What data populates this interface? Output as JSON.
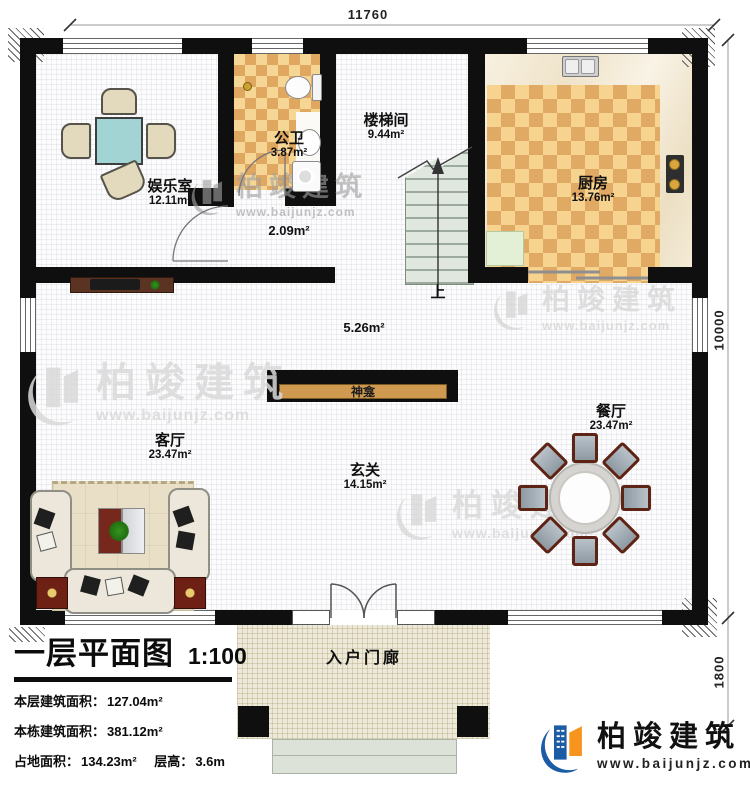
{
  "dimensions": {
    "top": "11760",
    "right_upper": "10000",
    "right_lower": "1800"
  },
  "rooms": {
    "entertainment": {
      "name": "娱乐室",
      "area": "12.11m²"
    },
    "bathroom": {
      "name": "公卫",
      "area": "3.87m²"
    },
    "corridor": {
      "area": "2.09m²"
    },
    "stairwell": {
      "name": "楼梯间",
      "area": "9.44m²"
    },
    "kitchen": {
      "name": "厨房",
      "area": "13.76m²"
    },
    "hall_mid": {
      "area": "5.26m²"
    },
    "shrine": {
      "name": "神龛"
    },
    "living": {
      "name": "客厅",
      "area": "23.47m²"
    },
    "foyer": {
      "name": "玄关",
      "area": "14.15m²"
    },
    "dining": {
      "name": "餐厅",
      "area": "23.47m²"
    },
    "porch": {
      "name": "入户门廊"
    }
  },
  "stairs": {
    "up_label": "上"
  },
  "title_block": {
    "title": "一层平面图",
    "scale": "1:100",
    "rows": [
      {
        "label": "本层建筑面积：",
        "value": "127.04m²"
      },
      {
        "label": "本栋建筑面积：",
        "value": "381.12m²"
      },
      {
        "label": "占地面积：",
        "value": "134.23m²",
        "label2": "层高：",
        "value2": "3.6m"
      }
    ]
  },
  "brand": {
    "name": "柏竣建筑",
    "url": "www.baijunjz.com"
  },
  "watermark": {
    "name": "柏竣建筑",
    "url": "www.baijunjz.com"
  },
  "colors": {
    "wall": "#0f0f0f",
    "tile_light": "#f6d694",
    "tile_dark": "#dfa760",
    "shrine_bar": "#cf9a50",
    "brand_blue": "#1b5ca5",
    "brand_orange": "#f6941e",
    "stair_tread": "#dfe7df"
  }
}
